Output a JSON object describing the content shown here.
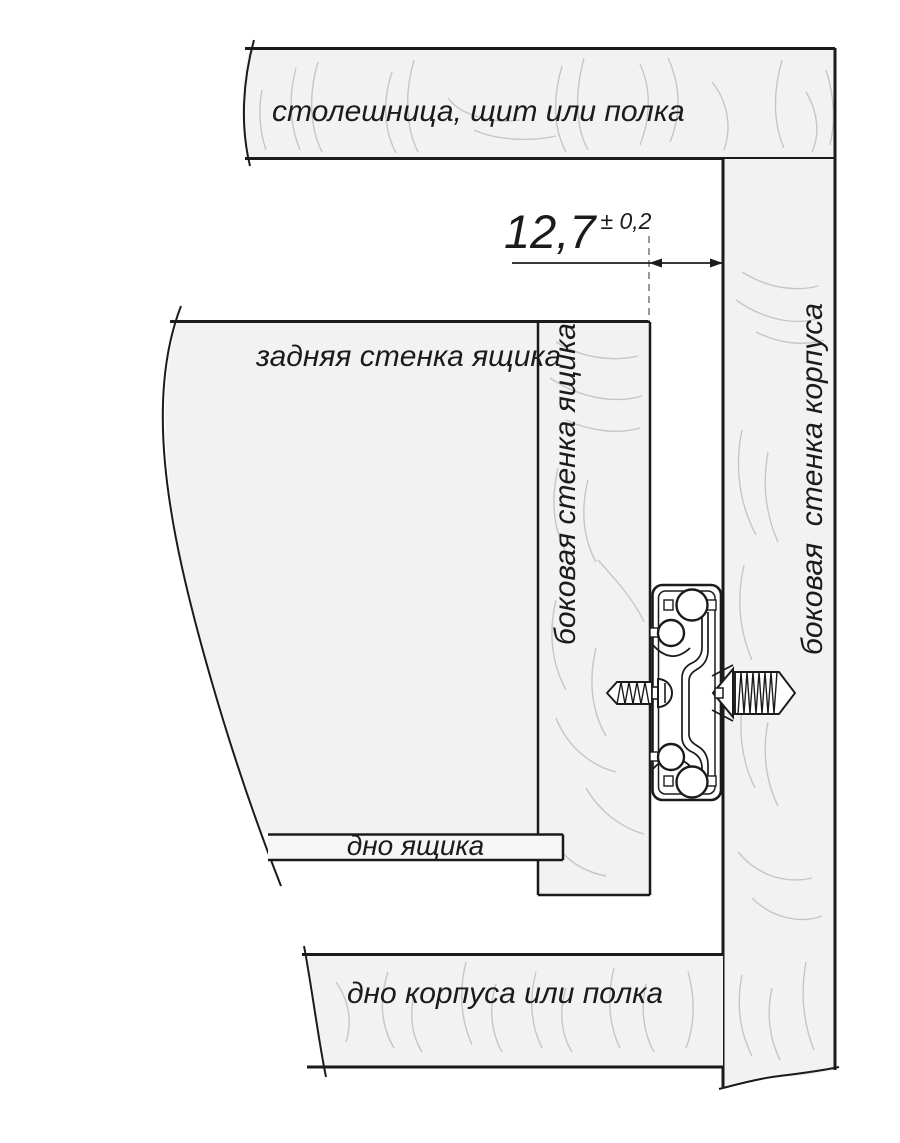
{
  "diagram": {
    "labels": {
      "top_panel": "столешница, щит или полка",
      "drawer_back": "задняя стенка ящика",
      "drawer_side": "боковая стенка ящика",
      "cabinet_side": "боковая  стенка корпуса",
      "drawer_bottom": "дно ящика",
      "cabinet_bottom": "дно корпуса или полка"
    },
    "dimension": {
      "value": "12,7",
      "tolerance": "± 0,2"
    },
    "icons": {
      "slide": "drawer-slide-cross-section",
      "screw_left": "screw-into-drawer-wall",
      "screw_right": "screw-into-cabinet-wall"
    },
    "colors": {
      "background": "#ffffff",
      "panel_fill": "#f2f2f2",
      "strip_fill": "#f6f6f6",
      "outline": "#1b1b1b",
      "wood_grain": "#c6c6c6",
      "dashed_line": "#8f8f8f"
    }
  }
}
